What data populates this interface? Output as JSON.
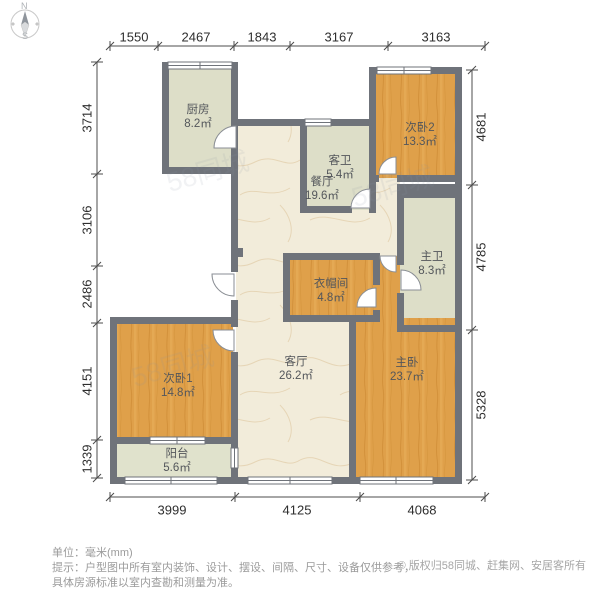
{
  "compass": {
    "north": "N",
    "south": "S"
  },
  "rooms": [
    {
      "id": "kitchen",
      "name": "厨房",
      "area": "8.2㎡"
    },
    {
      "id": "dining",
      "name": "餐厅",
      "area": "19.6㎡"
    },
    {
      "id": "guest-bath",
      "name": "客卫",
      "area": "5.4㎡"
    },
    {
      "id": "bedroom2",
      "name": "次卧2",
      "area": "13.3㎡"
    },
    {
      "id": "master-bath",
      "name": "主卫",
      "area": "8.3㎡"
    },
    {
      "id": "closet",
      "name": "衣帽间",
      "area": "4.8㎡"
    },
    {
      "id": "living",
      "name": "客厅",
      "area": "26.2㎡"
    },
    {
      "id": "master-bedroom",
      "name": "主卧",
      "area": "23.7㎡"
    },
    {
      "id": "bedroom1",
      "name": "次卧1",
      "area": "14.8㎡"
    },
    {
      "id": "balcony",
      "name": "阳台",
      "area": "5.6㎡"
    }
  ],
  "dimensions": {
    "top": [
      "1550",
      "2467",
      "1843",
      "3167",
      "3163"
    ],
    "left": [
      "3714",
      "3106",
      "2486",
      "4151",
      "1339"
    ],
    "right": [
      "4681",
      "4785",
      "5328"
    ],
    "bottom": [
      "3999",
      "4125",
      "4068"
    ]
  },
  "footer": {
    "unit_line": "单位：毫米(mm)",
    "tip_line1": "提示：户型图中所有室内装饰、设计、摆设、间隔、尺寸、设备仅供参考，",
    "tip_line2": "具体房源标准以室内查勘和测量为准。",
    "copyright": "© 版权归58同城、赶集网、安居客所有"
  },
  "watermark": {
    "text": "58同城"
  },
  "colors": {
    "wall": "#6f737a",
    "bedroom_floor": "#dfa04a",
    "bath_floor": "#dddec8",
    "hall_floor": "#f2ecda",
    "dimension_text": "#2e2e2e",
    "footer_text": "#9b9b9b"
  }
}
